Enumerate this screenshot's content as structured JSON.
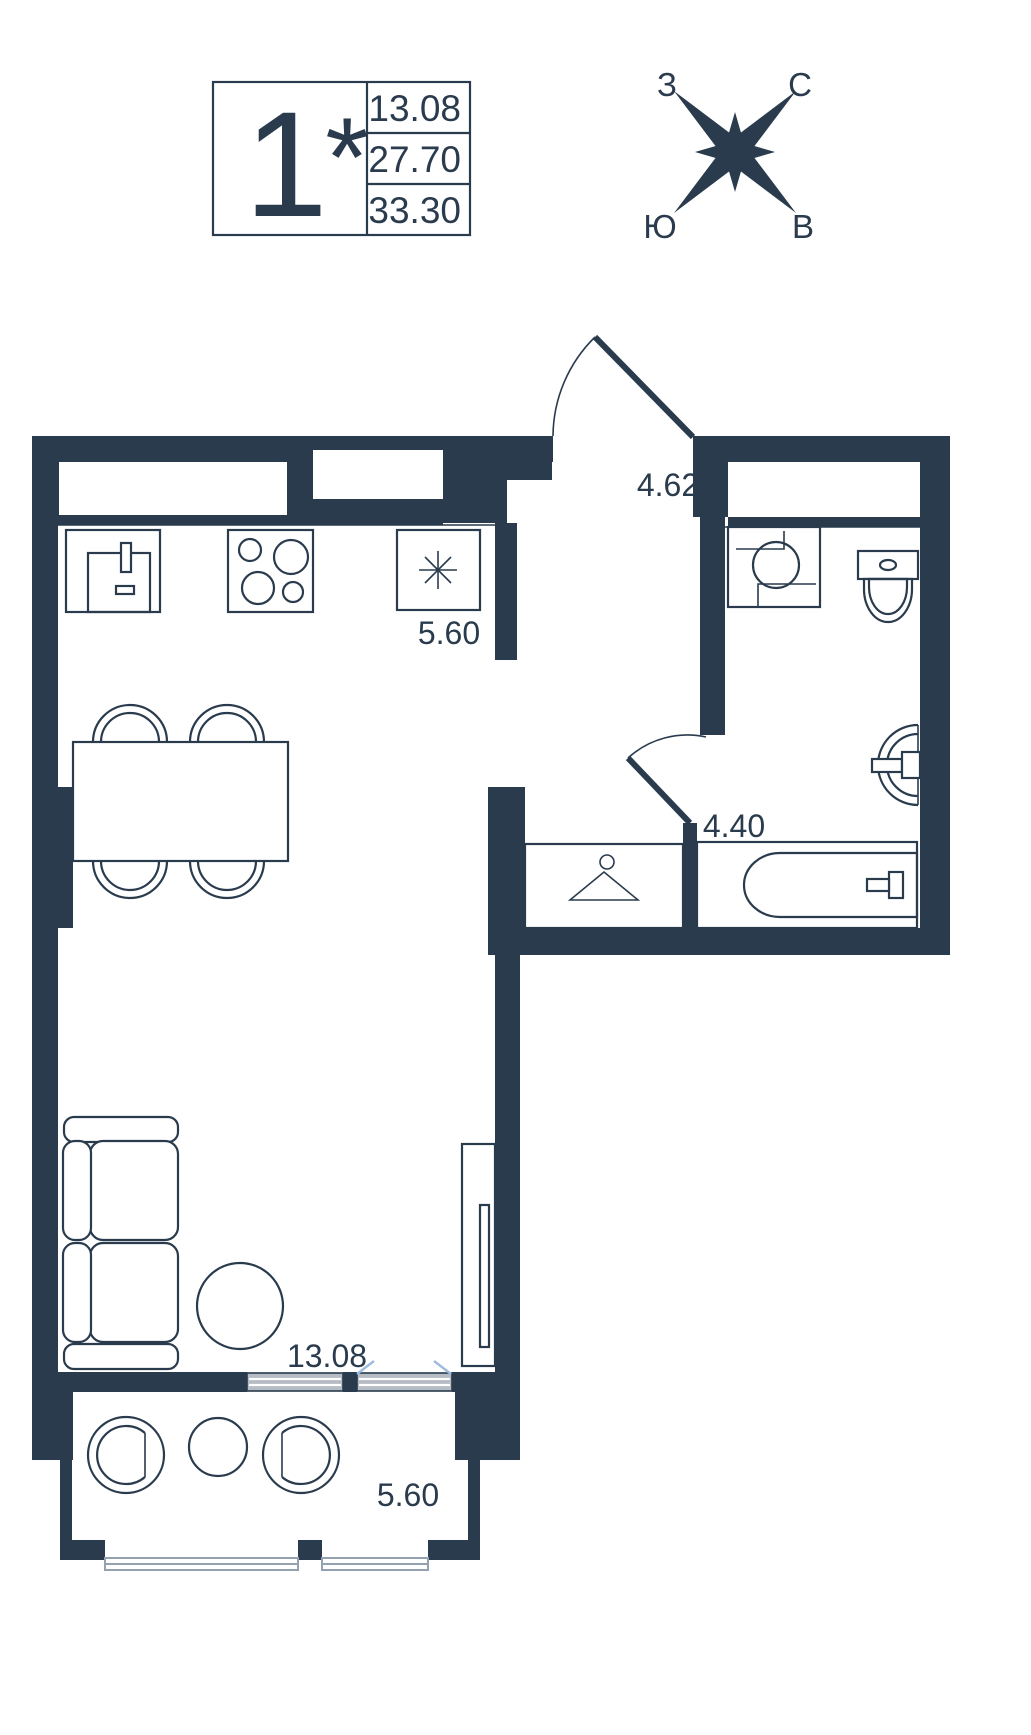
{
  "legend": {
    "rooms": "1",
    "star": "*",
    "values": [
      "13.08",
      "27.70",
      "33.30"
    ]
  },
  "compass": {
    "west": "З",
    "north": "С",
    "south": "Ю",
    "east": "В"
  },
  "labels": {
    "kitchen": "5.60",
    "hall": "4.62",
    "bathroom": "4.40",
    "living": "13.08",
    "balcony": "5.60"
  },
  "colors": {
    "wall": "#293b4d",
    "glazing": "#b6bcc4",
    "tick": "#9fbcdf",
    "sill": "#93a1b0"
  }
}
